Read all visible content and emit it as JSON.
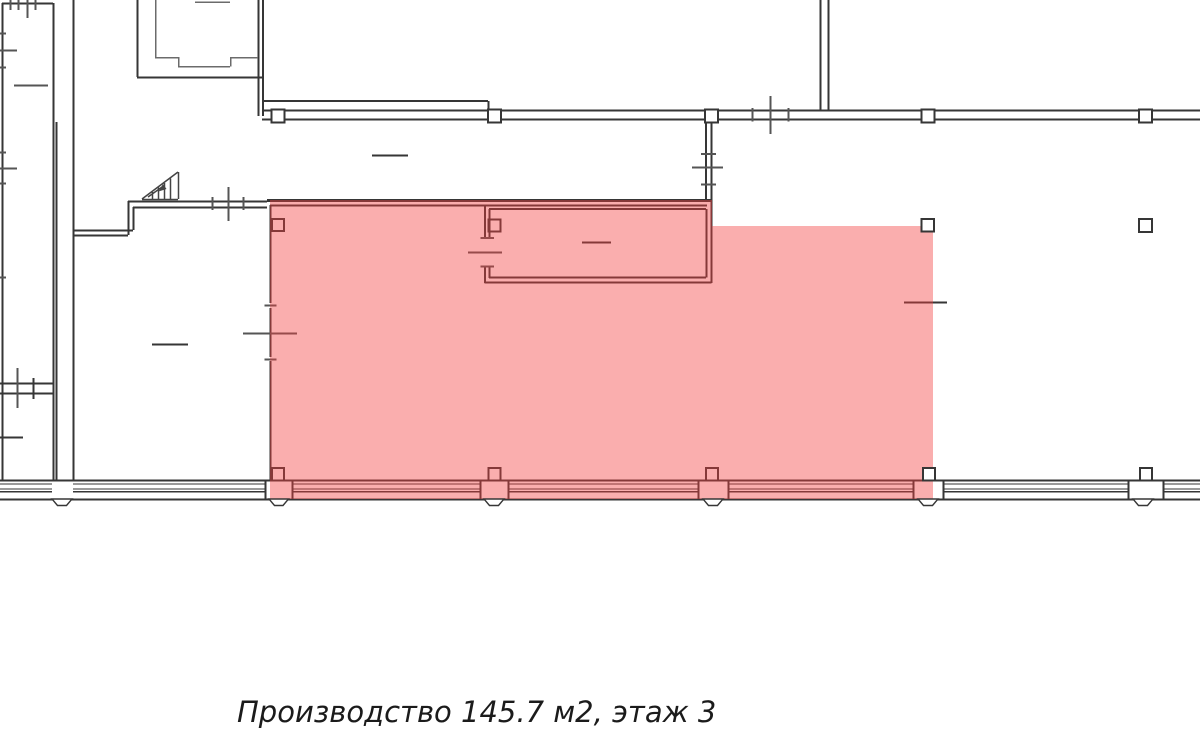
{
  "caption": {
    "text": "Производство 145.7 м2, этаж 3"
  },
  "room": {
    "name": "Производство",
    "area_m2": "145.7",
    "floor": "3",
    "highlighted": true
  },
  "colors": {
    "background": "#ffffff",
    "wall": "#363636",
    "wall_light": "#6b6b6b",
    "cross": "#555555",
    "stairs": "#444444",
    "highlight_fill": "rgba(244,62,62,0.42)",
    "caption_text": "#1b1b1b"
  }
}
